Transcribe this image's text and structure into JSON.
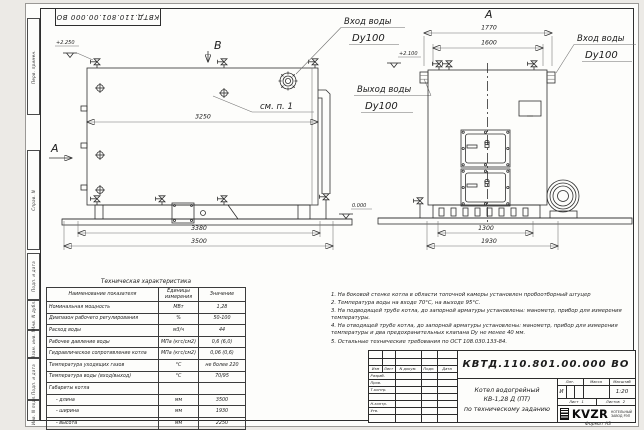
{
  "frame": {
    "stamp": "КВТД.110.801.00.000 ВО",
    "margin_labels": [
      "Перв. примен.",
      "Справ. N",
      "Подп. и дата",
      "Инв. N дубл.",
      "Взам. инв. N",
      "Подп. и дата",
      "Инв. N подл."
    ]
  },
  "side_view": {
    "section_label": "В",
    "view_label": "А",
    "elev_top": "+2.250",
    "elev_mid": "+2.100",
    "elev_zero": "0.000",
    "see_note": "см. п. 1",
    "dim_inner": "3250",
    "dim_frame": "3380",
    "dim_total": "3500",
    "inlet_line1": "Вход воды",
    "inlet_line2": "Dy100",
    "outlet_line1": "Выход воды",
    "outlet_line2": "Dy100"
  },
  "front_view": {
    "title": "А",
    "dim_outer": "1770",
    "dim_inner": "1600",
    "dim_frame": "1300",
    "dim_total": "1930",
    "inlet_line1": "Вход воды",
    "inlet_line2": "Dy100"
  },
  "tech_table": {
    "title": "Техническая характеристика",
    "headers": [
      "Наименование показателя",
      "Единицы измерения",
      "Значение"
    ],
    "rows": [
      {
        "name": "Номинальная мощность",
        "unit": "МВт",
        "value": "1,28"
      },
      {
        "name": "Диапазон рабочего регулирования",
        "unit": "%",
        "value": "50-100"
      },
      {
        "name": "Расход воды",
        "unit": "м3/ч",
        "value": "44"
      },
      {
        "name": "Рабочее давление воды",
        "unit": "МПа (кгс/см2)",
        "value": "0,6 (6,0)"
      },
      {
        "name": "Гидравлическое сопротивление котла",
        "unit": "МПа (кгс/см2)",
        "value": "0,06 (0,6)"
      },
      {
        "name": "Температура уходящих газов",
        "unit": "°С",
        "value": "не более 220"
      },
      {
        "name": "Температура воды (вход/выход)",
        "unit": "°С",
        "value": "70/95"
      },
      {
        "name": "Габариты котла",
        "unit": "",
        "value": ""
      },
      {
        "name": "- длина",
        "unit": "мм",
        "value": "3500"
      },
      {
        "name": "- ширина",
        "unit": "мм",
        "value": "1930"
      },
      {
        "name": "- высота",
        "unit": "мм",
        "value": "2250"
      }
    ]
  },
  "notes": [
    "1.  На боковой стенке котла в области топочной камеры установлен пробоотборный штуцер",
    "2.  Температура воды на входе 70°С, на выходе 95°С.",
    "3.  На подводящей трубе котла, до запорной арматуры установлены: манометр, прибор для измерения температуры.",
    "4.  На отводящей трубе котла, до запорной арматуры установлены: манометр, прибор для измерения температуры и два предохранительных клапана Dy не менее 40 мм.",
    "5.  Остальные технические требования по ОСТ 108.030.133-84."
  ],
  "title_block": {
    "doc_number": "КВТД.110.801.00.000  ВО",
    "product_line1": "Котел водогрейный",
    "product_line2": "КВ-1,28 Д (ПТ)",
    "product_line3": "по техническому заданию",
    "header_cells": [
      "Изм",
      "Лист",
      "N докум.",
      "Подп.",
      "Дата"
    ],
    "role_rows": [
      "Разраб.",
      "Пров.",
      "Т.контр.",
      "Н.контр.",
      "Утв."
    ],
    "lit_label": "Лит.",
    "mass_label": "Масса",
    "scale_label": "Масштаб",
    "lit_value": "И",
    "scale_value": "1:20",
    "sheet_label": "Лист",
    "sheet_value": "1",
    "sheets_label": "Листов",
    "sheets_value": "2",
    "logo_text": "KVZR",
    "logo_sub1": "КОТЕЛЬНЫЙ",
    "logo_sub2": "ЗАВОД РЭП",
    "format": "Формат  А3"
  }
}
